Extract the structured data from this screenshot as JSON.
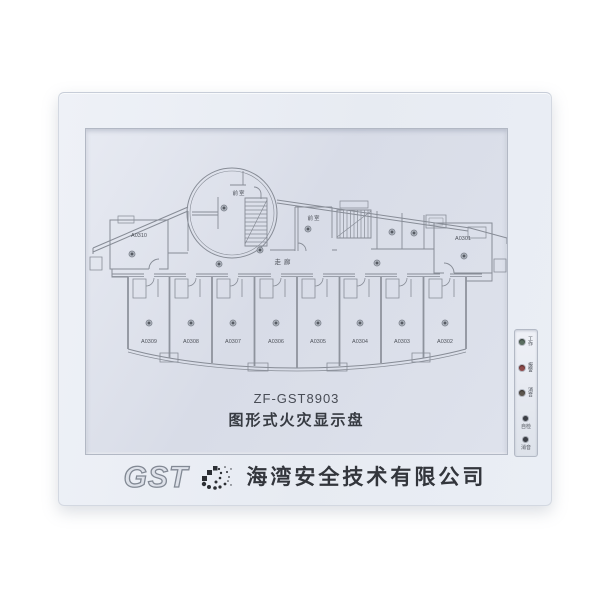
{
  "plate": {
    "model": "ZF-GST8903",
    "product_name": "图形式火灾显示盘"
  },
  "floor_plan": {
    "corridor": "走廊",
    "lobby_left": "前室",
    "lobby_right": "前室",
    "room_top_left": "A0310",
    "room_top_right": "A0301",
    "rooms_bottom": [
      "A0309",
      "A0308",
      "A0307",
      "A0306",
      "A0305",
      "A0304",
      "A0303",
      "A0302"
    ]
  },
  "indicators": {
    "leds": [
      {
        "label": "工作",
        "color": "#5a6e60"
      },
      {
        "label": "报警",
        "color": "#8f4a4a"
      },
      {
        "label": "消音",
        "color": "#5c564e"
      }
    ],
    "buttons": [
      {
        "label": "自检"
      },
      {
        "label": "消音"
      }
    ]
  },
  "branding": {
    "logo_text": "GST",
    "company": "海湾安全技术有限公司"
  },
  "colors": {
    "panel_face": "#e9ecf3",
    "plate": "#dde1ea",
    "etch_line": "#878c96",
    "led_power": "#5a6e60",
    "led_alarm": "#8f4a4a",
    "led_mute": "#5c564e"
  }
}
